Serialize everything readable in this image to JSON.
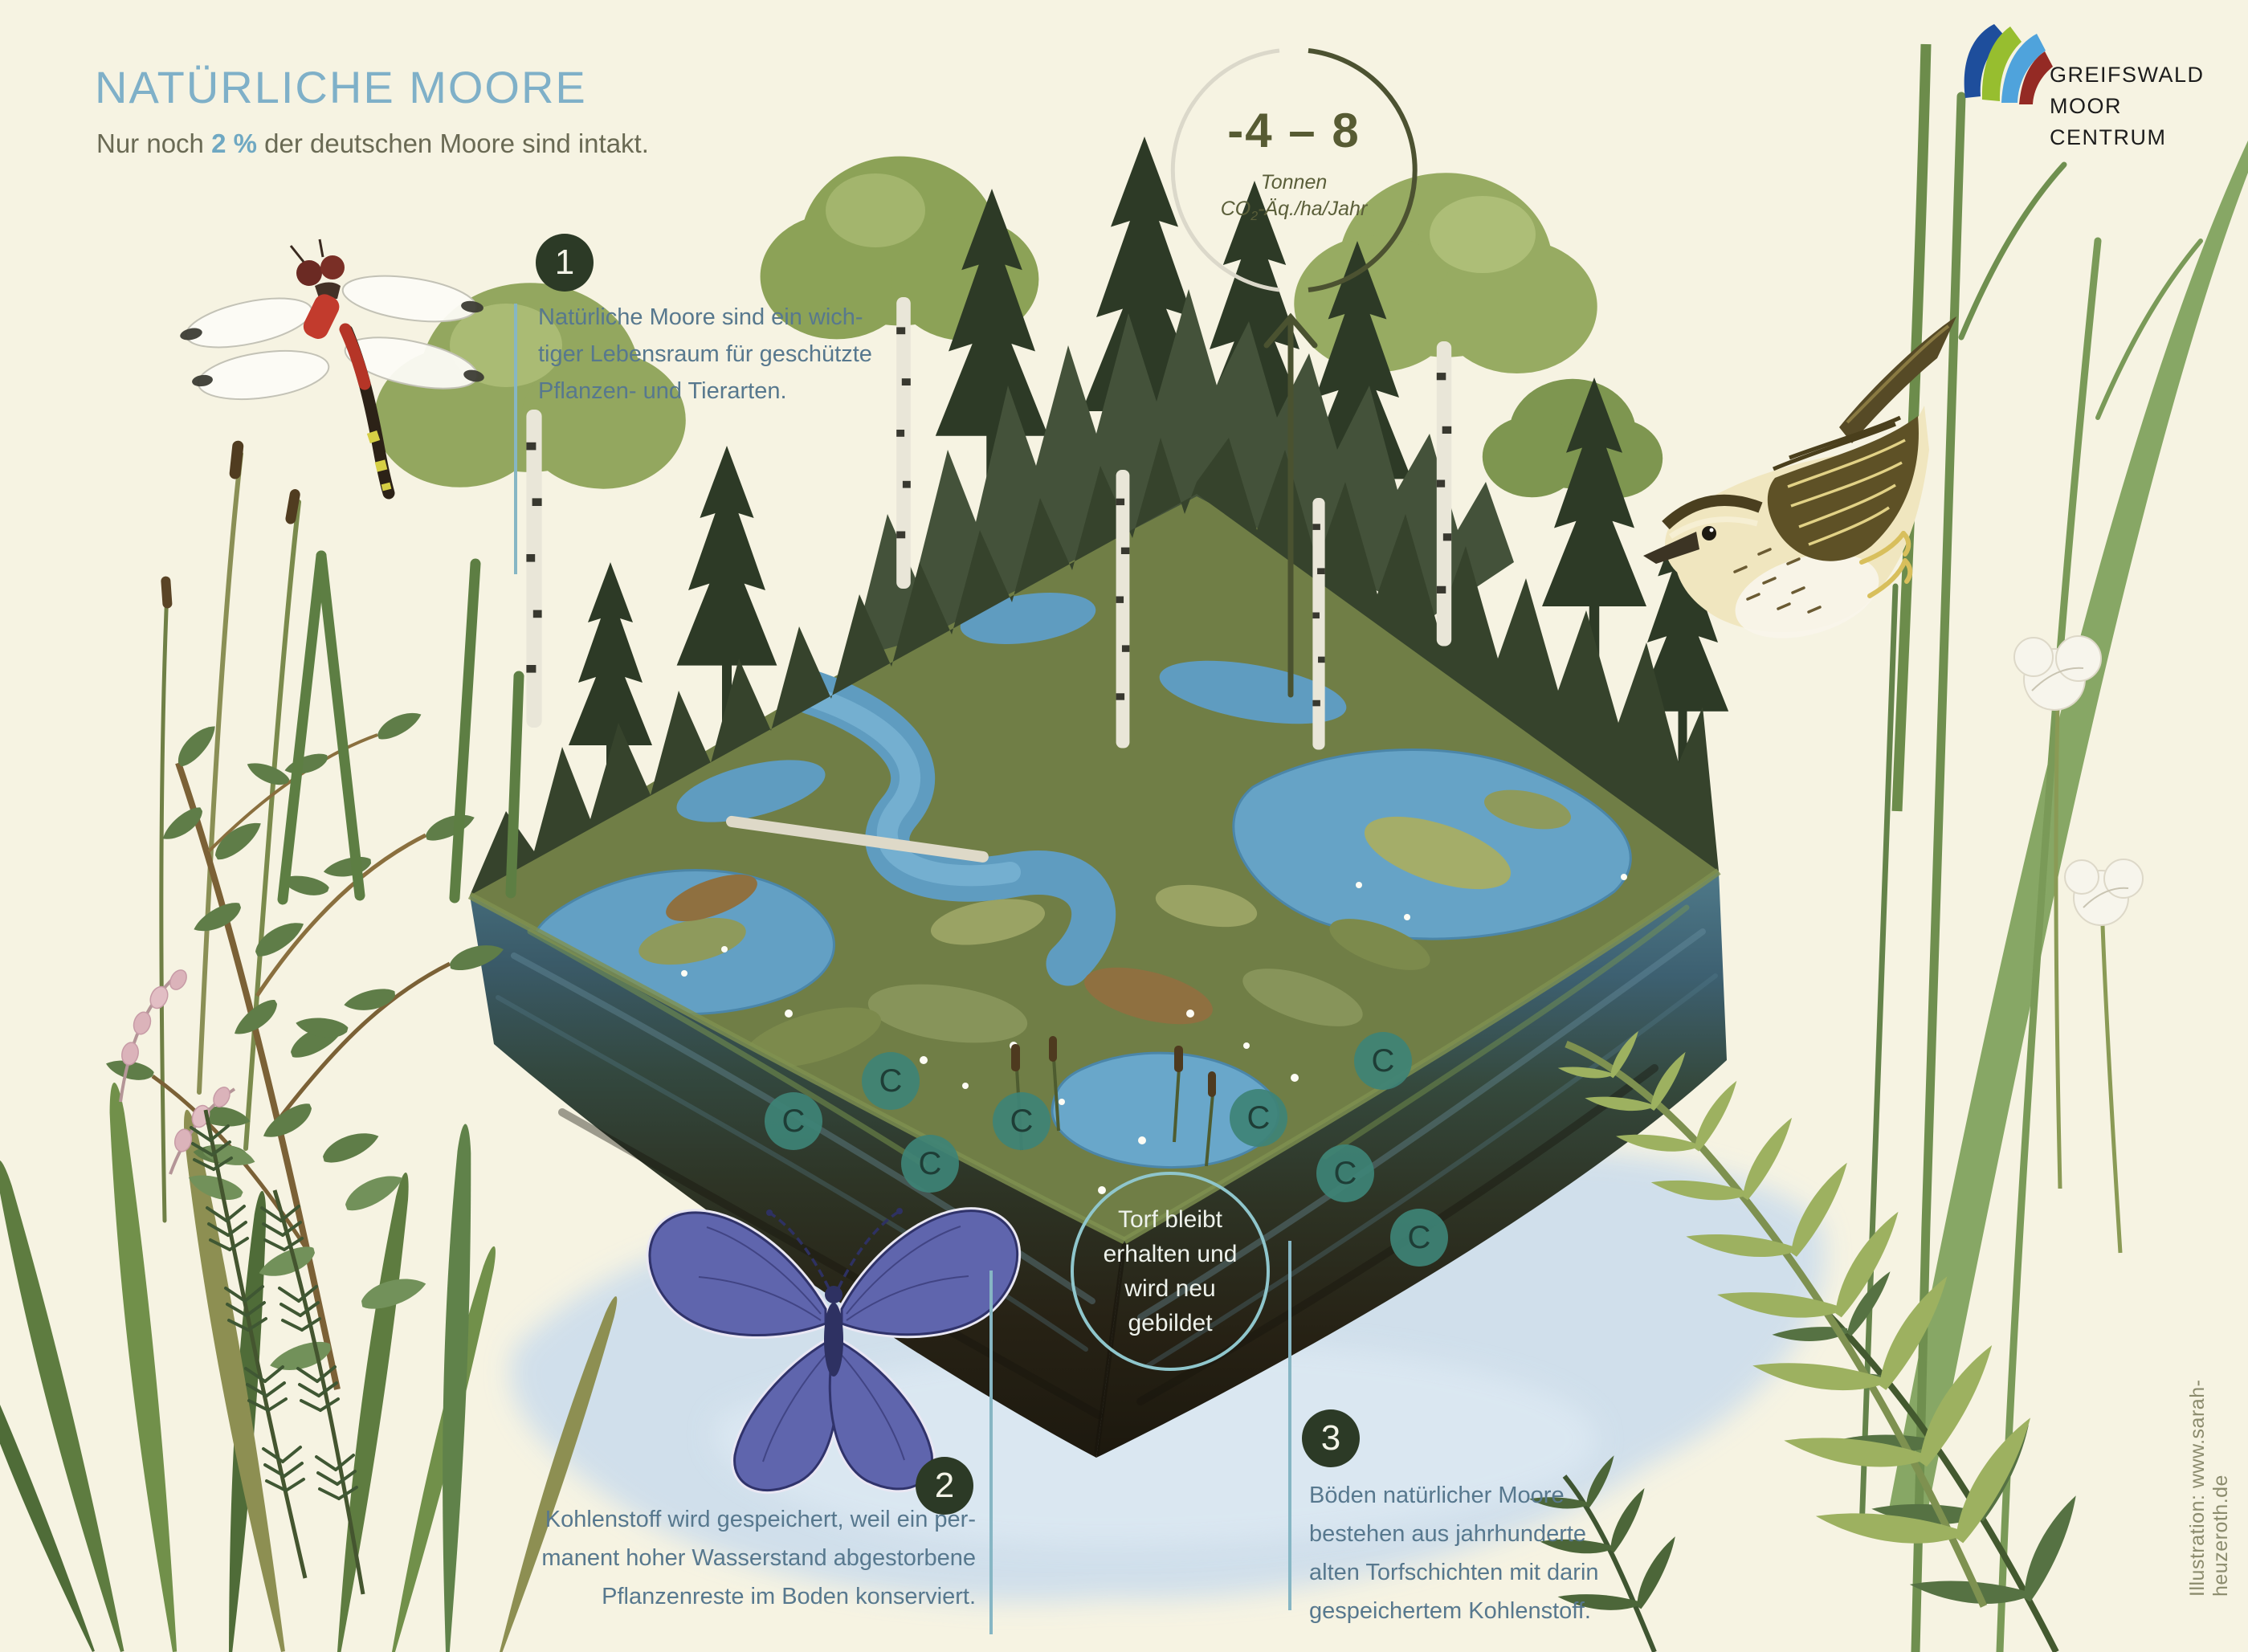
{
  "header": {
    "title": "NATÜRLICHE MOORE",
    "subtitle_prefix": "Nur noch ",
    "subtitle_stat": "2 %",
    "subtitle_suffix": " der deutschen Moore sind intakt."
  },
  "emission_badge": {
    "value": "-4 – 8",
    "unit_line1": "Tonnen",
    "co2_prefix": "CO",
    "co2_sub": "2",
    "co2_suffix": "-Äq./ha/Jahr"
  },
  "steps": [
    {
      "number": "1",
      "lines": [
        "Natürliche Moore sind ein wich-",
        "tiger Lebensraum für geschützte",
        "Pflanzen- und Tierarten."
      ]
    },
    {
      "number": "2",
      "lines": [
        "Kohlenstoff wird gespeichert, weil ein per-",
        "manent hoher Wasserstand abgestorbene",
        "Pflanzenreste im Boden konserviert."
      ]
    },
    {
      "number": "3",
      "lines": [
        "Böden natürlicher Moore",
        "bestehen aus jahrhunderte",
        "alten Torfschichten mit darin",
        "gespeichertem Kohlenstoff."
      ]
    }
  ],
  "peat_note": {
    "lines": [
      "Torf bleibt",
      "erhalten und",
      "wird neu",
      "gebildet"
    ]
  },
  "carbon_markers": {
    "symbol": "C",
    "count": 8
  },
  "logo": {
    "lines": [
      "GREIFSWALD",
      "MOOR",
      "CENTRUM"
    ]
  },
  "credit": "Illustration: www.sarah-heuzeroth.de",
  "colors": {
    "background": "#f6f3e2",
    "title": "#7fb0c8",
    "subtitle_stat": "#6fa8c2",
    "body_text": "#57788e",
    "step_badge": "#2c3a26",
    "stat_olive": "#575b33",
    "carbon_circle": "#3e8376",
    "peat_ring": "#8fc6cc",
    "connector_line": "#86b6c4",
    "logo_blue": "#1e4e9c",
    "logo_green": "#97be2f",
    "logo_lightblue": "#4fa3dc",
    "logo_red": "#942a24"
  }
}
